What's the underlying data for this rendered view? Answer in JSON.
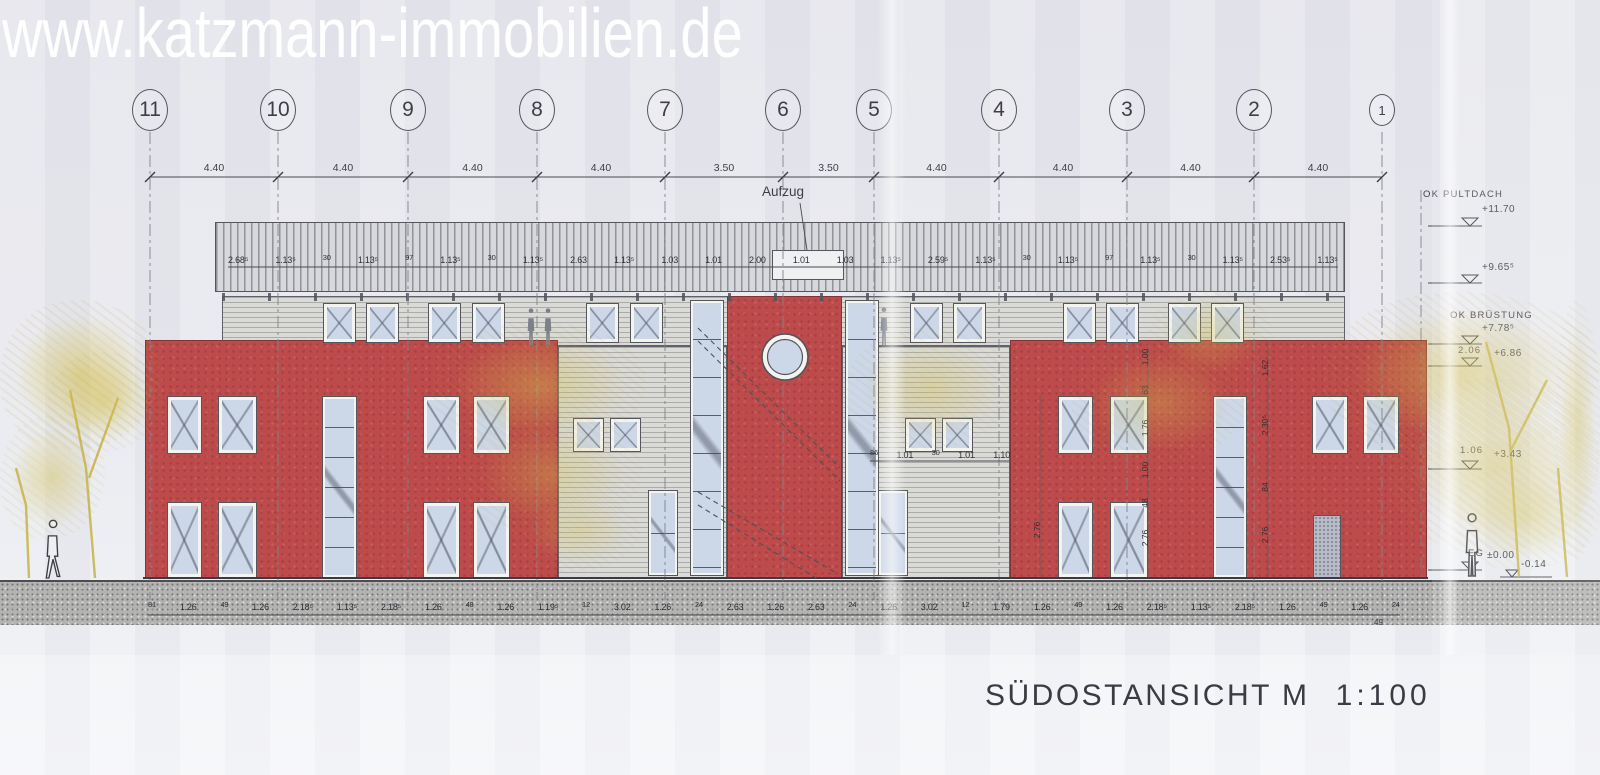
{
  "watermark": {
    "text": "www.katzmann-immobilien.de"
  },
  "title_block": {
    "title": "SÜDOSTANSICHT",
    "scale": "M  1:100"
  },
  "drawing_labels": {
    "elevator": "Aufzug"
  },
  "grid_axes": [
    {
      "label": "11",
      "x": 150
    },
    {
      "label": "10",
      "x": 278
    },
    {
      "label": "9",
      "x": 408
    },
    {
      "label": "8",
      "x": 537
    },
    {
      "label": "7",
      "x": 665
    },
    {
      "label": "6",
      "x": 783
    },
    {
      "label": "5",
      "x": 874
    },
    {
      "label": "4",
      "x": 999
    },
    {
      "label": "3",
      "x": 1127
    },
    {
      "label": "2",
      "x": 1254
    },
    {
      "label": "1",
      "x": 1382,
      "small": true
    }
  ],
  "top_dimension_labels": [
    "4.40",
    "4.40",
    "4.40",
    "4.40",
    "3.50",
    "3.50",
    "4.40",
    "4.40",
    "4.40",
    "4.40"
  ],
  "roof_dimension_labels": [
    "2.68⁵",
    "1.13⁵",
    "30",
    "1.13⁵",
    "97",
    "1.13⁵",
    "30",
    "1.13⁵",
    "2.63",
    "1.13⁵",
    "1.03",
    "1.01",
    "2.00",
    "1.01",
    "1.03",
    "1.13⁵",
    "2.59⁵",
    "1.13⁵",
    "30",
    "1.13⁵",
    "97",
    "1.13⁵",
    "30",
    "1.13⁵",
    "2.53⁵",
    "1.13⁵"
  ],
  "bottom_dimension_labels": [
    "81",
    "1.26",
    "49",
    "1.26",
    "2.18⁵",
    "1.13⁵",
    "2.18⁵",
    "1.26",
    "48",
    "1.26",
    "1.19⁵",
    "12",
    "3.02",
    "1.26",
    "24",
    "2.63",
    "1.26",
    "2.63",
    "24",
    "1.26",
    "3.02",
    "12",
    "1.79",
    "1.26",
    "49",
    "1.26",
    "2.18⁵",
    "1.13⁵",
    "2.18⁵",
    "1.26",
    "49",
    "1.26",
    "24"
  ],
  "bottom_dimension_tail": "49",
  "mid_dimension_labels": [
    "86",
    "1.01",
    "30",
    "1.01",
    "1.10"
  ],
  "vertical_dimension_labels": [
    {
      "text": "2.76",
      "x": 1037,
      "y": 530
    },
    {
      "text": "1.00",
      "x": 1145,
      "y": 357
    },
    {
      "text": "63",
      "x": 1145,
      "y": 390
    },
    {
      "text": "1.76",
      "x": 1145,
      "y": 428
    },
    {
      "text": "1.00",
      "x": 1145,
      "y": 470
    },
    {
      "text": "48",
      "x": 1145,
      "y": 503
    },
    {
      "text": "2.76",
      "x": 1145,
      "y": 538
    },
    {
      "text": "1.62",
      "x": 1265,
      "y": 368
    },
    {
      "text": "2.30⁵",
      "x": 1265,
      "y": 425
    },
    {
      "text": "84",
      "x": 1265,
      "y": 487
    },
    {
      "text": "2.76",
      "x": 1265,
      "y": 535
    }
  ],
  "level_markers": [
    {
      "name": "OK PULTDACH",
      "nx": 1423,
      "ny": 190,
      "value": "+11.70",
      "vx": 1482,
      "vy": 205,
      "ly": 226
    },
    {
      "value": "+9.65⁵",
      "vx": 1482,
      "vy": 263,
      "ly": 283
    },
    {
      "name": "OK BRÜSTUNG",
      "nx": 1450,
      "ny": 311,
      "value": "+7.78⁵",
      "vx": 1482,
      "vy": 324,
      "ly": 344
    },
    {
      "name": "2.06",
      "nx": 1458,
      "ny": 346,
      "value": "+6.86",
      "vx": 1494,
      "vy": 349,
      "ly": 366
    },
    {
      "name": "1.06",
      "nx": 1460,
      "ny": 446,
      "value": "+3.43",
      "vx": 1494,
      "vy": 450,
      "ly": 469
    },
    {
      "name": "EG",
      "nx": 1468,
      "ny": 549,
      "value": "±0.00",
      "vx": 1487,
      "vy": 551,
      "ly": 570
    },
    {
      "value": "-0.14",
      "vx": 1521,
      "vy": 560,
      "ly": 577,
      "short": true
    }
  ],
  "colors": {
    "paper": "#e9eaef",
    "facade_red": "#bd4b4b",
    "glass_blue": "#ccd7e8",
    "siding_gray": "#dadad6",
    "roof_gray": "#d6d8db",
    "ground_gray": "#b3b3b1",
    "tree_yellow": "#d3be4c",
    "line": "#55555c",
    "text": "#3e3e46",
    "watermark": "#ffffff"
  },
  "layout": {
    "sections": [
      {
        "t": "siding",
        "x": 222,
        "y": 296,
        "w": 1123,
        "h": 50
      },
      {
        "t": "siding",
        "x": 558,
        "y": 346,
        "w": 169,
        "h": 232
      },
      {
        "t": "siding",
        "x": 842,
        "y": 346,
        "w": 168,
        "h": 232
      },
      {
        "t": "red",
        "x": 145,
        "y": 340,
        "w": 413,
        "h": 238
      },
      {
        "t": "red",
        "x": 727,
        "y": 296,
        "w": 115,
        "h": 282
      },
      {
        "t": "red",
        "x": 1010,
        "y": 340,
        "w": 417,
        "h": 238
      }
    ],
    "roof": {
      "x": 215,
      "y": 222,
      "w": 1130,
      "h": 70
    },
    "elevator_box": {
      "x": 772,
      "y": 250,
      "w": 72,
      "h": 30
    },
    "ground": {
      "x": 0,
      "y": 580,
      "w": 1600,
      "h": 45
    },
    "windows": [
      {
        "k": "x",
        "x": 323,
        "y": 303,
        "w": 33,
        "h": 40
      },
      {
        "k": "x",
        "x": 366,
        "y": 303,
        "w": 33,
        "h": 40
      },
      {
        "k": "x",
        "x": 428,
        "y": 303,
        "w": 33,
        "h": 40
      },
      {
        "k": "x",
        "x": 472,
        "y": 303,
        "w": 33,
        "h": 40
      },
      {
        "k": "x",
        "x": 586,
        "y": 303,
        "w": 33,
        "h": 40
      },
      {
        "k": "x",
        "x": 630,
        "y": 303,
        "w": 33,
        "h": 40
      },
      {
        "k": "x",
        "x": 910,
        "y": 303,
        "w": 33,
        "h": 40
      },
      {
        "k": "x",
        "x": 953,
        "y": 303,
        "w": 33,
        "h": 40
      },
      {
        "k": "x",
        "x": 1063,
        "y": 303,
        "w": 33,
        "h": 40
      },
      {
        "k": "x",
        "x": 1106,
        "y": 303,
        "w": 33,
        "h": 40
      },
      {
        "k": "x",
        "x": 1168,
        "y": 303,
        "w": 33,
        "h": 40
      },
      {
        "k": "x",
        "x": 1211,
        "y": 303,
        "w": 33,
        "h": 40
      },
      {
        "k": "x",
        "x": 167,
        "y": 396,
        "w": 35,
        "h": 58
      },
      {
        "k": "x",
        "x": 218,
        "y": 396,
        "w": 39,
        "h": 58
      },
      {
        "k": "x",
        "x": 423,
        "y": 396,
        "w": 37,
        "h": 58
      },
      {
        "k": "x",
        "x": 473,
        "y": 396,
        "w": 37,
        "h": 58
      },
      {
        "k": "x",
        "x": 1058,
        "y": 396,
        "w": 35,
        "h": 58
      },
      {
        "k": "x",
        "x": 1110,
        "y": 396,
        "w": 38,
        "h": 58
      },
      {
        "k": "x",
        "x": 1312,
        "y": 396,
        "w": 36,
        "h": 58
      },
      {
        "k": "x",
        "x": 1363,
        "y": 396,
        "w": 36,
        "h": 58
      },
      {
        "k": "x",
        "x": 167,
        "y": 502,
        "w": 35,
        "h": 76
      },
      {
        "k": "x",
        "x": 218,
        "y": 502,
        "w": 39,
        "h": 76
      },
      {
        "k": "x",
        "x": 423,
        "y": 502,
        "w": 37,
        "h": 76
      },
      {
        "k": "x",
        "x": 473,
        "y": 502,
        "w": 37,
        "h": 76
      },
      {
        "k": "x",
        "x": 1058,
        "y": 502,
        "w": 35,
        "h": 76
      },
      {
        "k": "x",
        "x": 1110,
        "y": 502,
        "w": 38,
        "h": 76
      },
      {
        "k": "x",
        "x": 573,
        "y": 418,
        "w": 31,
        "h": 34
      },
      {
        "k": "x",
        "x": 610,
        "y": 418,
        "w": 31,
        "h": 34
      },
      {
        "k": "x",
        "x": 905,
        "y": 418,
        "w": 31,
        "h": 34
      },
      {
        "k": "x",
        "x": 942,
        "y": 418,
        "w": 31,
        "h": 34
      },
      {
        "k": "s",
        "x": 322,
        "y": 396,
        "w": 35,
        "h": 182,
        "p": 30
      },
      {
        "k": "s",
        "x": 1213,
        "y": 396,
        "w": 34,
        "h": 182,
        "p": 30
      },
      {
        "k": "s",
        "x": 690,
        "y": 300,
        "w": 34,
        "h": 276,
        "p": 38
      },
      {
        "k": "s",
        "x": 845,
        "y": 300,
        "w": 34,
        "h": 276,
        "p": 38
      },
      {
        "k": "s",
        "x": 648,
        "y": 490,
        "w": 30,
        "h": 86,
        "p": 42
      },
      {
        "k": "s",
        "x": 878,
        "y": 490,
        "w": 30,
        "h": 86,
        "p": 42
      },
      {
        "k": "d",
        "x": 1313,
        "y": 515,
        "w": 28,
        "h": 63
      }
    ],
    "stairs": [
      [
        698,
        328,
        840,
        468
      ],
      [
        698,
        341,
        840,
        481
      ],
      [
        698,
        492,
        838,
        574
      ],
      [
        698,
        505,
        816,
        578
      ]
    ],
    "round_window": {
      "cx": 785,
      "cy": 357,
      "r_out": 23,
      "r_in": 17.5
    },
    "foliage": [
      [
        0,
        300,
        160,
        150,
        0.65
      ],
      [
        0,
        415,
        105,
        125,
        0.5
      ],
      [
        48,
        352,
        115,
        100,
        0.5
      ],
      [
        432,
        322,
        215,
        128,
        0.5
      ],
      [
        462,
        412,
        180,
        125,
        0.42
      ],
      [
        515,
        492,
        125,
        80,
        0.35
      ],
      [
        845,
        328,
        170,
        122,
        0.42
      ],
      [
        1072,
        342,
        175,
        122,
        0.4
      ],
      [
        1148,
        288,
        125,
        95,
        0.38
      ],
      [
        1325,
        292,
        275,
        165,
        0.6
      ],
      [
        1390,
        378,
        210,
        175,
        0.55
      ],
      [
        1450,
        465,
        150,
        105,
        0.45
      ],
      [
        1555,
        300,
        45,
        260,
        0.5
      ]
    ],
    "tree_trunks": [
      "95,578 86,468 70,390",
      "89,478 118,398",
      "29,578 26,505 16,468",
      "1519,577 1509,428 1486,342",
      "1511,450 1547,380",
      "1567,577 1558,468"
    ],
    "people": [
      {
        "x": 52,
        "y": 578,
        "h": 52,
        "style": "outline",
        "pose": "walk"
      },
      {
        "x": 531,
        "y": 345,
        "h": 33,
        "style": "solid",
        "pose": "stand"
      },
      {
        "x": 548,
        "y": 345,
        "h": 33,
        "style": "solid",
        "pose": "stand"
      },
      {
        "x": 884,
        "y": 345,
        "h": 34,
        "style": "solid",
        "pose": "stand"
      },
      {
        "x": 1472,
        "y": 576,
        "h": 56,
        "style": "outline",
        "pose": "stand"
      }
    ]
  }
}
